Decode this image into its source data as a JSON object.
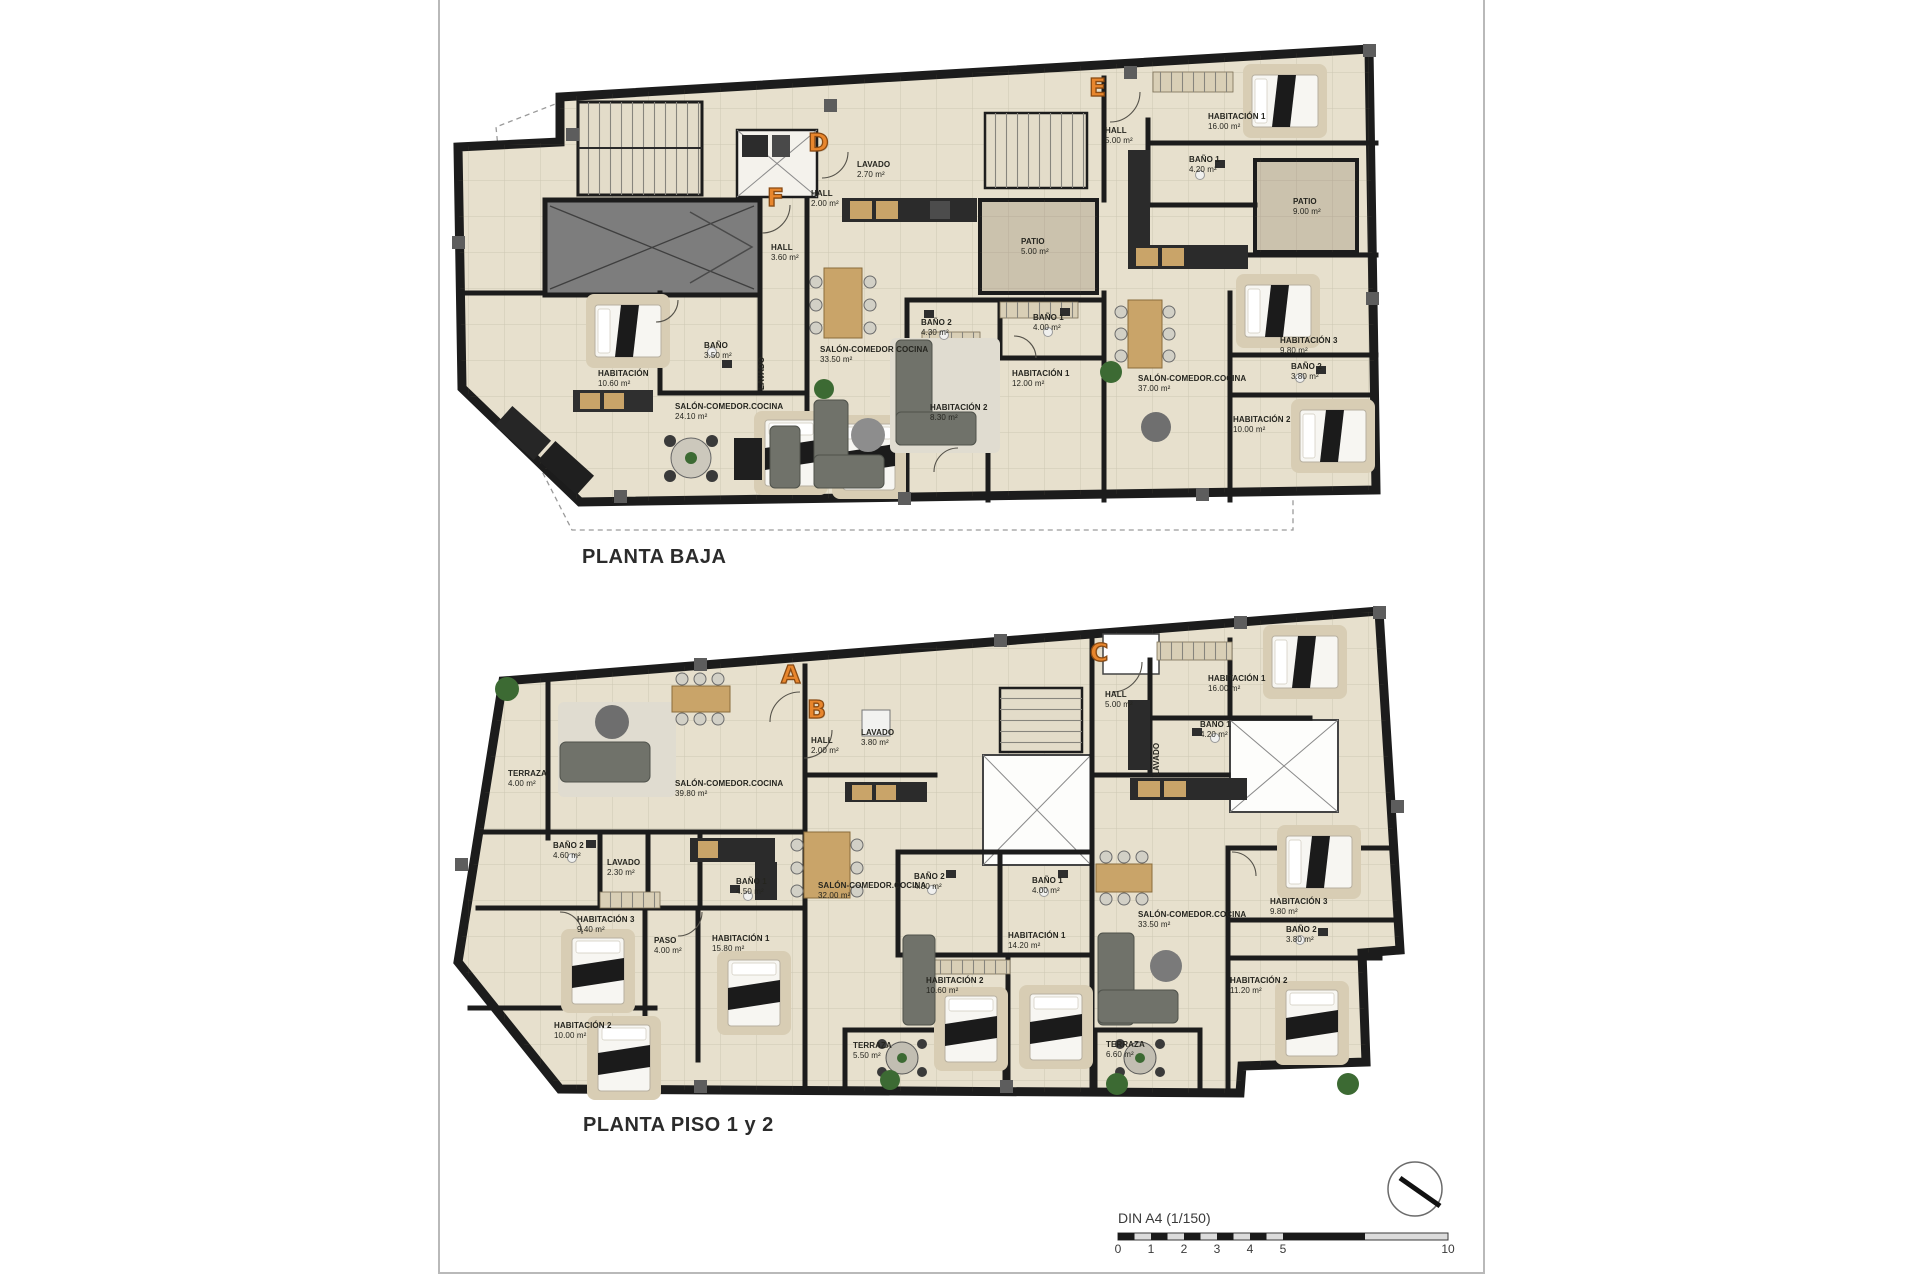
{
  "page": {
    "background": "#ffffff",
    "frame_color": "#b9b9b9"
  },
  "scale_bar": {
    "label": "DIN A4 (1/150)",
    "ticks": [
      "0",
      "1",
      "2",
      "3",
      "4",
      "5",
      "10"
    ]
  },
  "north_indicator": "north-arrow",
  "colors": {
    "wall": "#1c1c1c",
    "floor": "#e7e0cd",
    "patio": "#cbc2ad",
    "garage": "#7d7d7d",
    "accent_letter": "#e8862d",
    "wood": "#c9a469",
    "sofa": "#70726a",
    "plant": "#3c6a33"
  },
  "plans": [
    {
      "id": "planta-baja",
      "title": "PLANTA BAJA",
      "letters": [
        "F",
        "D",
        "E"
      ],
      "rooms": [
        {
          "name": "HALL",
          "area": "3.60 m²"
        },
        {
          "name": "BAÑO",
          "area": "3.50 m²"
        },
        {
          "name": "LAVADO",
          "area": ""
        },
        {
          "name": "HABITACIÓN",
          "area": "10.60 m²"
        },
        {
          "name": "SALÓN-COMEDOR.COCINA",
          "area": "24.10 m²"
        },
        {
          "name": "LAVADO",
          "area": "2.70 m²"
        },
        {
          "name": "HALL",
          "area": "2.00 m²"
        },
        {
          "name": "SALÓN-COMEDOR COCINA",
          "area": "33.50 m²"
        },
        {
          "name": "BAÑO 2",
          "area": "4.30 m²"
        },
        {
          "name": "BAÑO 1",
          "area": "4.00 m²"
        },
        {
          "name": "HABITACIÓN 1",
          "area": "12.00 m²"
        },
        {
          "name": "HABITACIÓN 2",
          "area": "8.30 m²"
        },
        {
          "name": "PATIO",
          "area": "5.00 m²"
        },
        {
          "name": "HALL",
          "area": "5.00 m²"
        },
        {
          "name": "HABITACIÓN 1",
          "area": "16.00 m²"
        },
        {
          "name": "BAÑO 1",
          "area": "4.20 m²"
        },
        {
          "name": "PATIO",
          "area": "9.00 m²"
        },
        {
          "name": "SALÓN-COMEDOR.COCINA",
          "area": "37.00 m²"
        },
        {
          "name": "HABITACIÓN 3",
          "area": "9.80 m²"
        },
        {
          "name": "BAÑO 2",
          "area": "3.80 m²"
        },
        {
          "name": "HABITACIÓN 2",
          "area": "10.00 m²"
        }
      ]
    },
    {
      "id": "planta-piso-1-y-2",
      "title": "PLANTA PISO 1 y 2",
      "letters": [
        "A",
        "B",
        "C"
      ],
      "rooms": [
        {
          "name": "TERRAZA",
          "area": "4.00 m²"
        },
        {
          "name": "SALÓN-COMEDOR.COCINA",
          "area": "39.80 m²"
        },
        {
          "name": "BAÑO 2",
          "area": "4.60 m²"
        },
        {
          "name": "LAVADO",
          "area": "2.30 m²"
        },
        {
          "name": "BAÑO 1",
          "area": "4.50 m²"
        },
        {
          "name": "HABITACIÓN 3",
          "area": "9.40 m²"
        },
        {
          "name": "PASO",
          "area": "4.00 m²"
        },
        {
          "name": "HABITACIÓN 1",
          "area": "15.80 m²"
        },
        {
          "name": "HABITACIÓN 2",
          "area": "10.00 m²"
        },
        {
          "name": "HALL",
          "area": "2.00 m²"
        },
        {
          "name": "LAVADO",
          "area": "3.80 m²"
        },
        {
          "name": "SALÓN-COMEDOR.COCINA",
          "area": "32.00 m²"
        },
        {
          "name": "BAÑO 2",
          "area": "4.30 m²"
        },
        {
          "name": "BAÑO 1",
          "area": "4.00 m²"
        },
        {
          "name": "HABITACIÓN 1",
          "area": "14.20 m²"
        },
        {
          "name": "HABITACIÓN 2",
          "area": "10.60 m²"
        },
        {
          "name": "TERRAZA",
          "area": "5.50 m²"
        },
        {
          "name": "HALL",
          "area": "5.00 m²"
        },
        {
          "name": "HABITACIÓN 1",
          "area": "16.00 m²"
        },
        {
          "name": "BAÑO 1",
          "area": "4.20 m²"
        },
        {
          "name": "LAVADO",
          "area": ""
        },
        {
          "name": "SALÓN-COMEDOR.COCINA",
          "area": "33.50 m²"
        },
        {
          "name": "HABITACIÓN 3",
          "area": "9.80 m²"
        },
        {
          "name": "BAÑO 2",
          "area": "3.80 m²"
        },
        {
          "name": "HABITACIÓN 2",
          "area": "11.20 m²"
        },
        {
          "name": "TERRAZA",
          "area": "6.60 m²"
        }
      ]
    }
  ]
}
